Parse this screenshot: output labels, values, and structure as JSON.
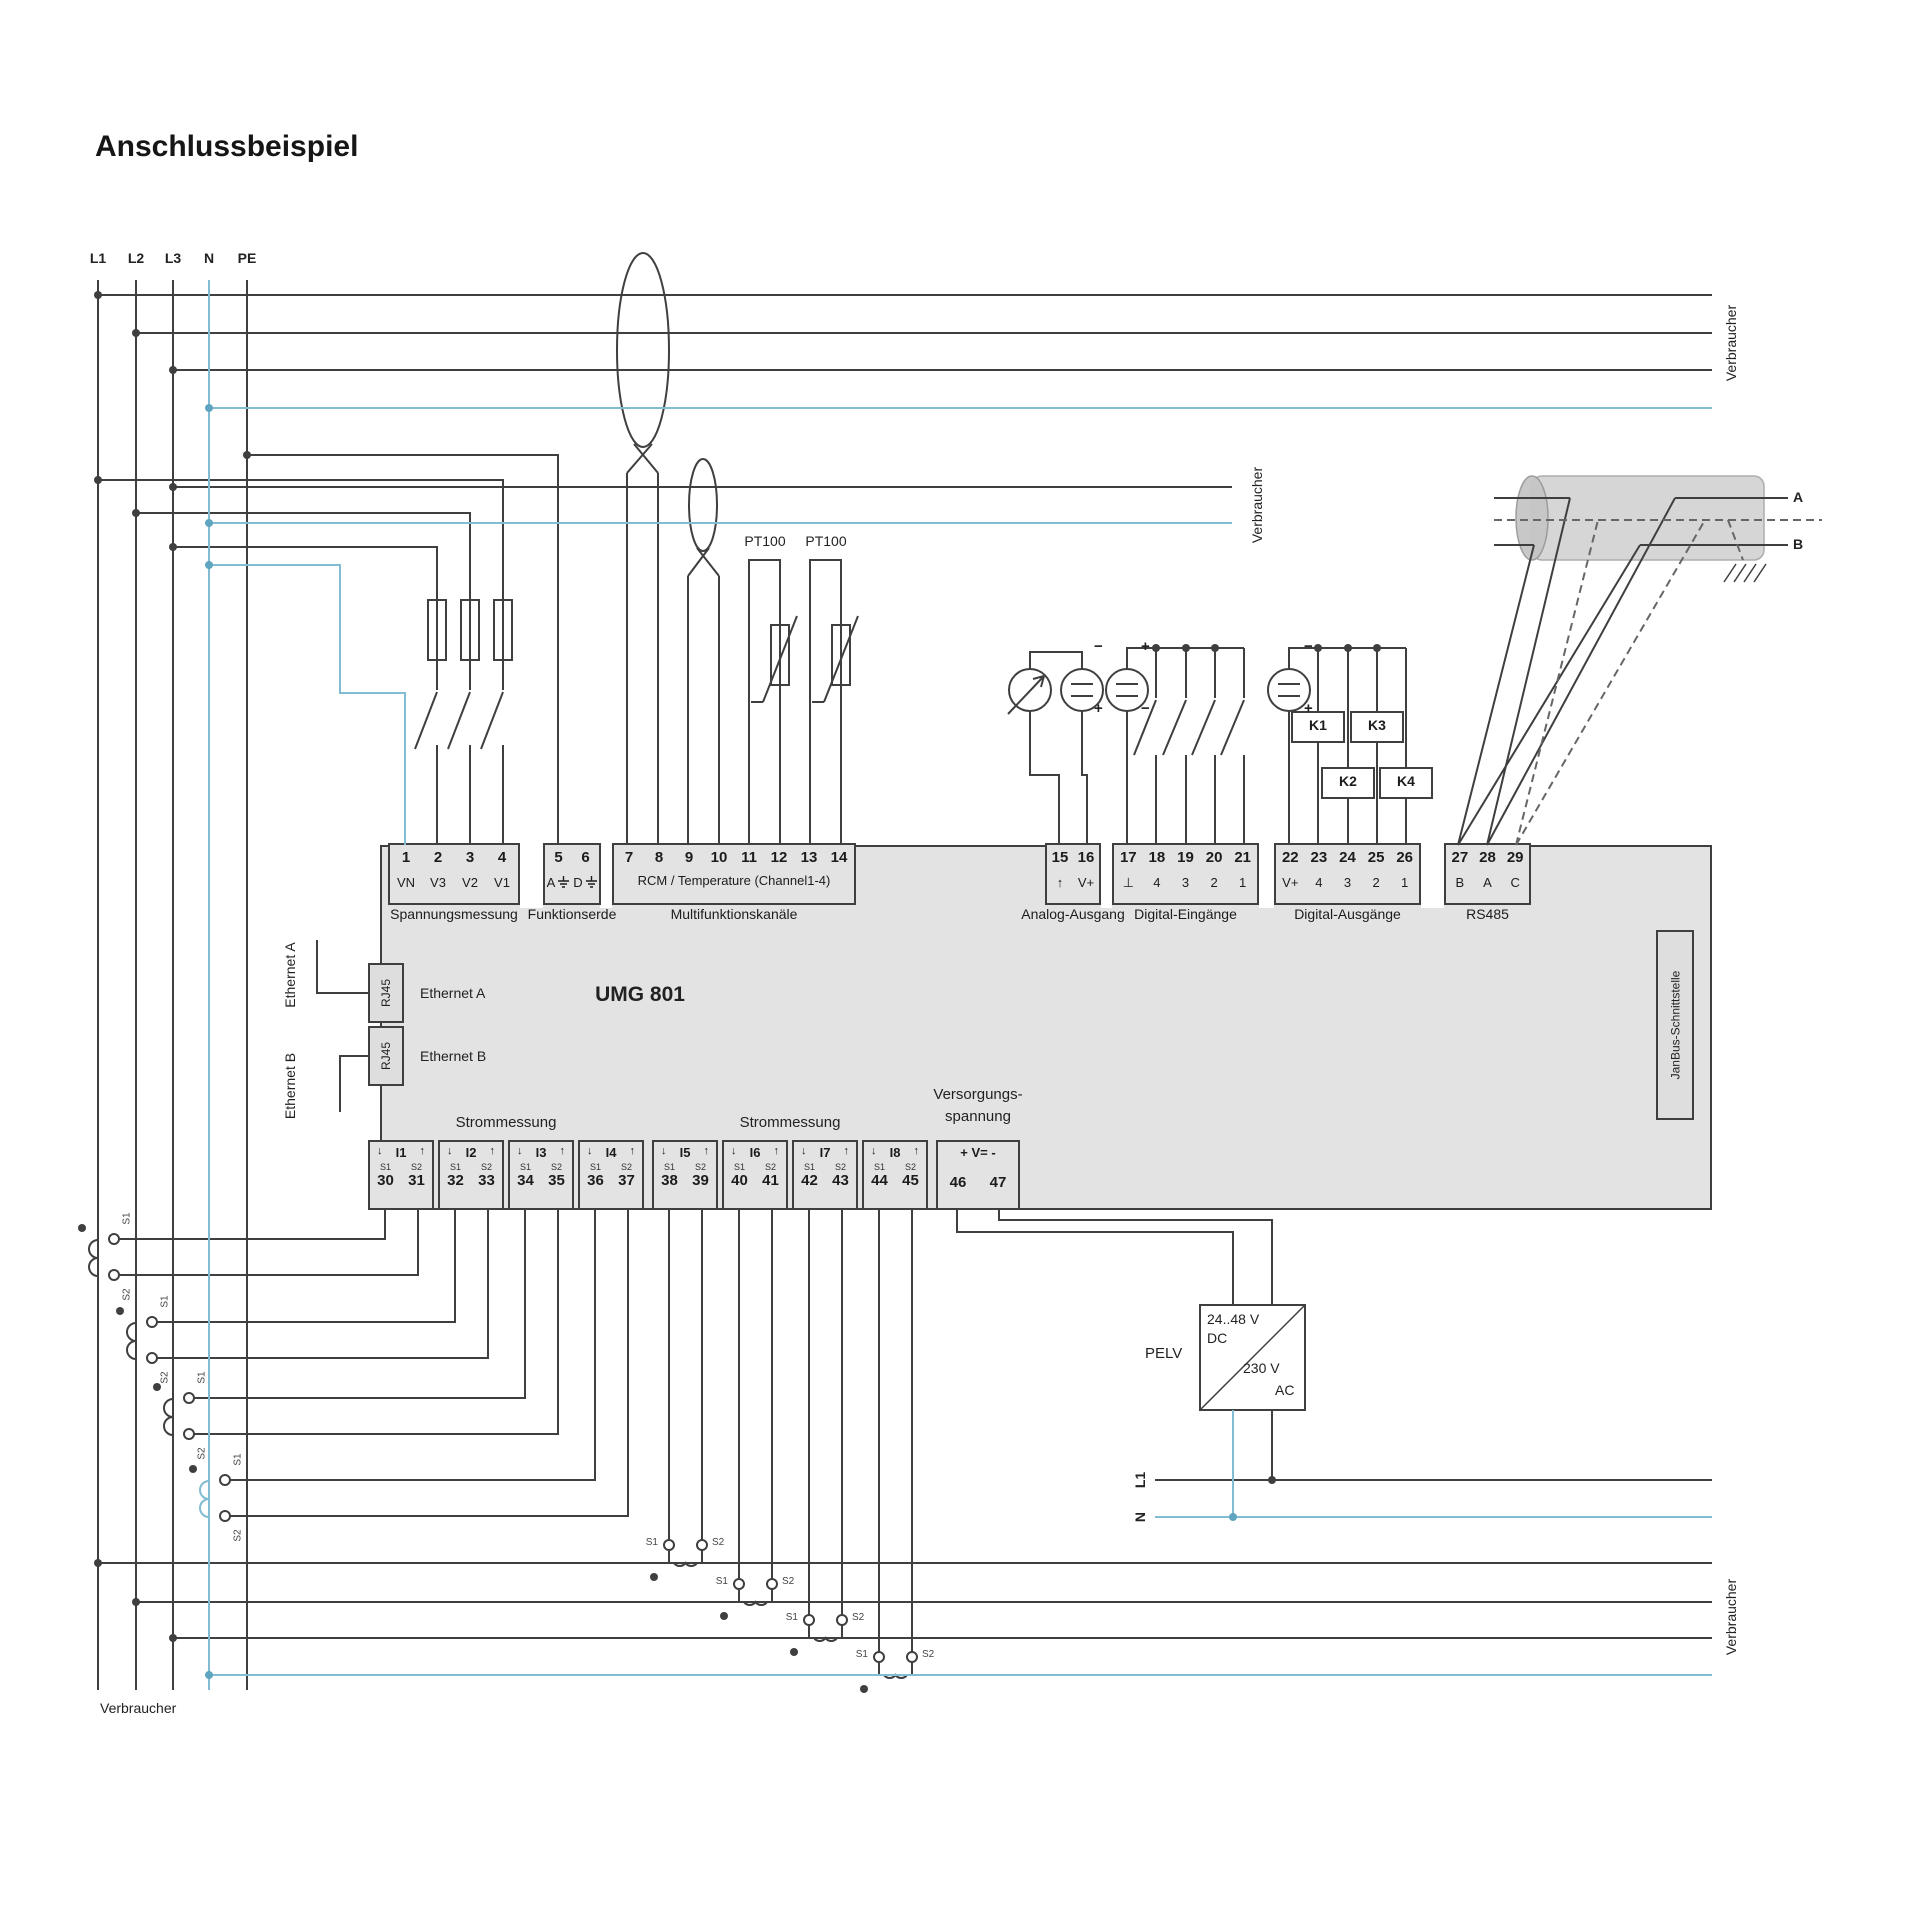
{
  "title": "Anschlussbeispiel",
  "buses": {
    "l1": "L1",
    "l2": "L2",
    "l3": "L3",
    "n": "N",
    "pe": "PE"
  },
  "consumers": {
    "top": "Verbraucher",
    "middle": "Verbraucher",
    "bottom_right": "Verbraucher",
    "bottom_left": "Verbraucher"
  },
  "device": {
    "name": "UMG 801",
    "ethernet_a": "Ethernet A",
    "ethernet_b": "Ethernet B",
    "ethernet_a_ext": "Ethernet A",
    "ethernet_b_ext": "Ethernet B",
    "rj45": "RJ45",
    "janbus": "JanBus-Schnittstelle"
  },
  "top_blocks": {
    "voltage": {
      "caption": "Spannungsmessung",
      "n": [
        "1",
        "2",
        "3",
        "4"
      ],
      "l": [
        "VN",
        "V3",
        "V2",
        "V1"
      ]
    },
    "earth": {
      "caption": "Funktionserde",
      "n": [
        "5",
        "6"
      ],
      "l": [
        "A",
        "D"
      ]
    },
    "multi": {
      "caption": "Multifunktionskanäle",
      "n": [
        "7",
        "8",
        "9",
        "10",
        "11",
        "12",
        "13",
        "14"
      ],
      "label": "RCM / Temperature (Channel1-4)"
    },
    "analog": {
      "caption": "Analog-Ausgang",
      "n": [
        "15",
        "16"
      ],
      "l": [
        "↑",
        "V+"
      ]
    },
    "din": {
      "caption": "Digital-Eingänge",
      "n": [
        "17",
        "18",
        "19",
        "20",
        "21"
      ],
      "l": [
        "⊥",
        "4",
        "3",
        "2",
        "1"
      ]
    },
    "dout": {
      "caption": "Digital-Ausgänge",
      "n": [
        "22",
        "23",
        "24",
        "25",
        "26"
      ],
      "l": [
        "V+",
        "4",
        "3",
        "2",
        "1"
      ]
    },
    "rs485": {
      "caption": "RS485",
      "n": [
        "27",
        "28",
        "29"
      ],
      "l": [
        "B",
        "A",
        "C"
      ]
    }
  },
  "bottom_blocks": {
    "caption_left": "Strommessung",
    "caption_right": "Strommessung",
    "arrow_down": "↓",
    "arrow_up": "↑",
    "s1": "S1",
    "s2": "S2",
    "channels": [
      {
        "name": "I1",
        "n1": "30",
        "n2": "31"
      },
      {
        "name": "I2",
        "n1": "32",
        "n2": "33"
      },
      {
        "name": "I3",
        "n1": "34",
        "n2": "35"
      },
      {
        "name": "I4",
        "n1": "36",
        "n2": "37"
      },
      {
        "name": "I5",
        "n1": "38",
        "n2": "39"
      },
      {
        "name": "I6",
        "n1": "40",
        "n2": "41"
      },
      {
        "name": "I7",
        "n1": "42",
        "n2": "43"
      },
      {
        "name": "I8",
        "n1": "44",
        "n2": "45"
      }
    ],
    "supply": {
      "caption1": "Versorgungs-",
      "caption2": "spannung",
      "label": "+ V= -",
      "n1": "46",
      "n2": "47"
    }
  },
  "sensors": {
    "pt100_1": "PT100",
    "pt100_2": "PT100"
  },
  "relays": {
    "k1": "K1",
    "k2": "K2",
    "k3": "K3",
    "k4": "K4"
  },
  "signs": {
    "plus": "+",
    "minus": "−"
  },
  "pelv": {
    "label": "PELV",
    "dc_v": "24..48 V",
    "dc": "DC",
    "ac_v": "230 V",
    "ac": "AC",
    "l1": "L1",
    "n": "N"
  },
  "cable": {
    "a": "A",
    "b": "B"
  },
  "colors": {
    "wire": "#3f3f3f",
    "neutral": "#82bcd2",
    "body": "#e3e3e3"
  }
}
